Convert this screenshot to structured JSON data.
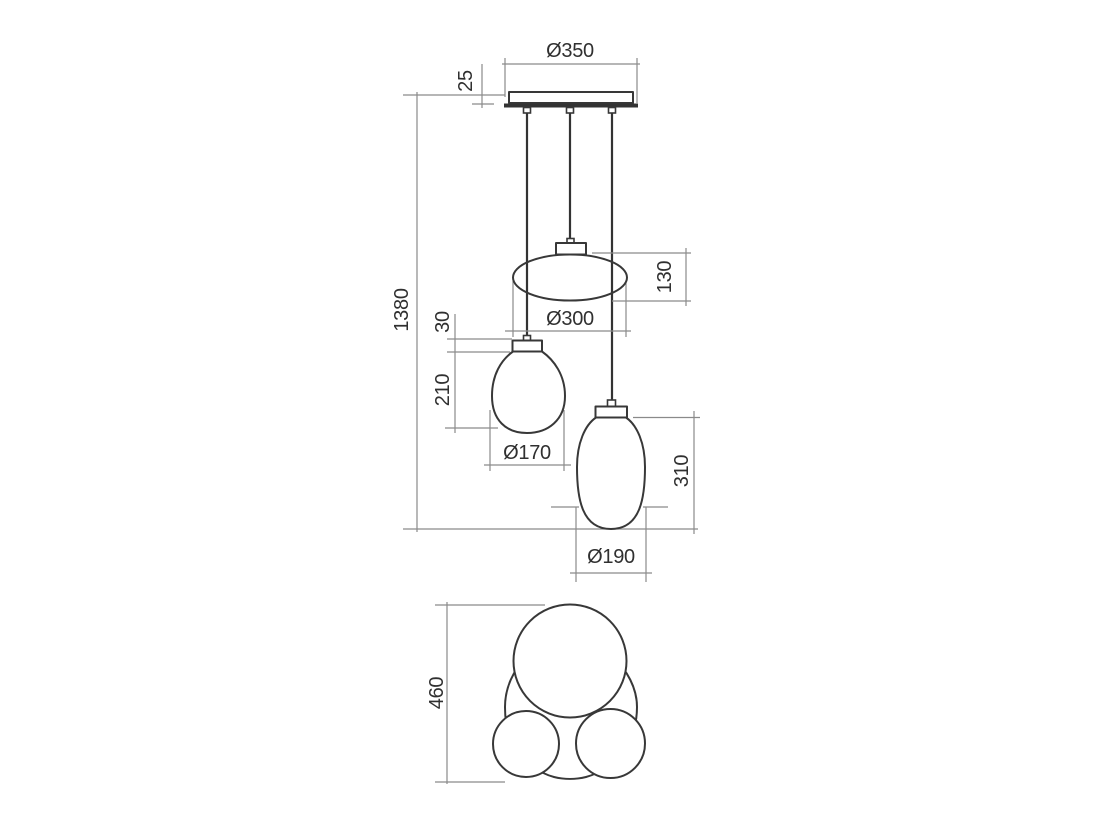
{
  "front_view": {
    "overall_height_label": "1380",
    "canopy": {
      "diameter_label": "Ø350",
      "height_label": "25"
    },
    "oval_shade": {
      "height_label": "130",
      "diameter_label": "Ø300"
    },
    "teardrop_shade": {
      "cap_height_label": "30",
      "height_label": "210",
      "diameter_label": "Ø170"
    },
    "ovoid_shade": {
      "height_label": "310",
      "diameter_label": "Ø190"
    }
  },
  "top_view": {
    "overall_height_label": "460"
  },
  "colors": {
    "background": "#ffffff",
    "outline": "#383838",
    "dimension_lines": "#8a8a8a",
    "text": "#303030"
  }
}
